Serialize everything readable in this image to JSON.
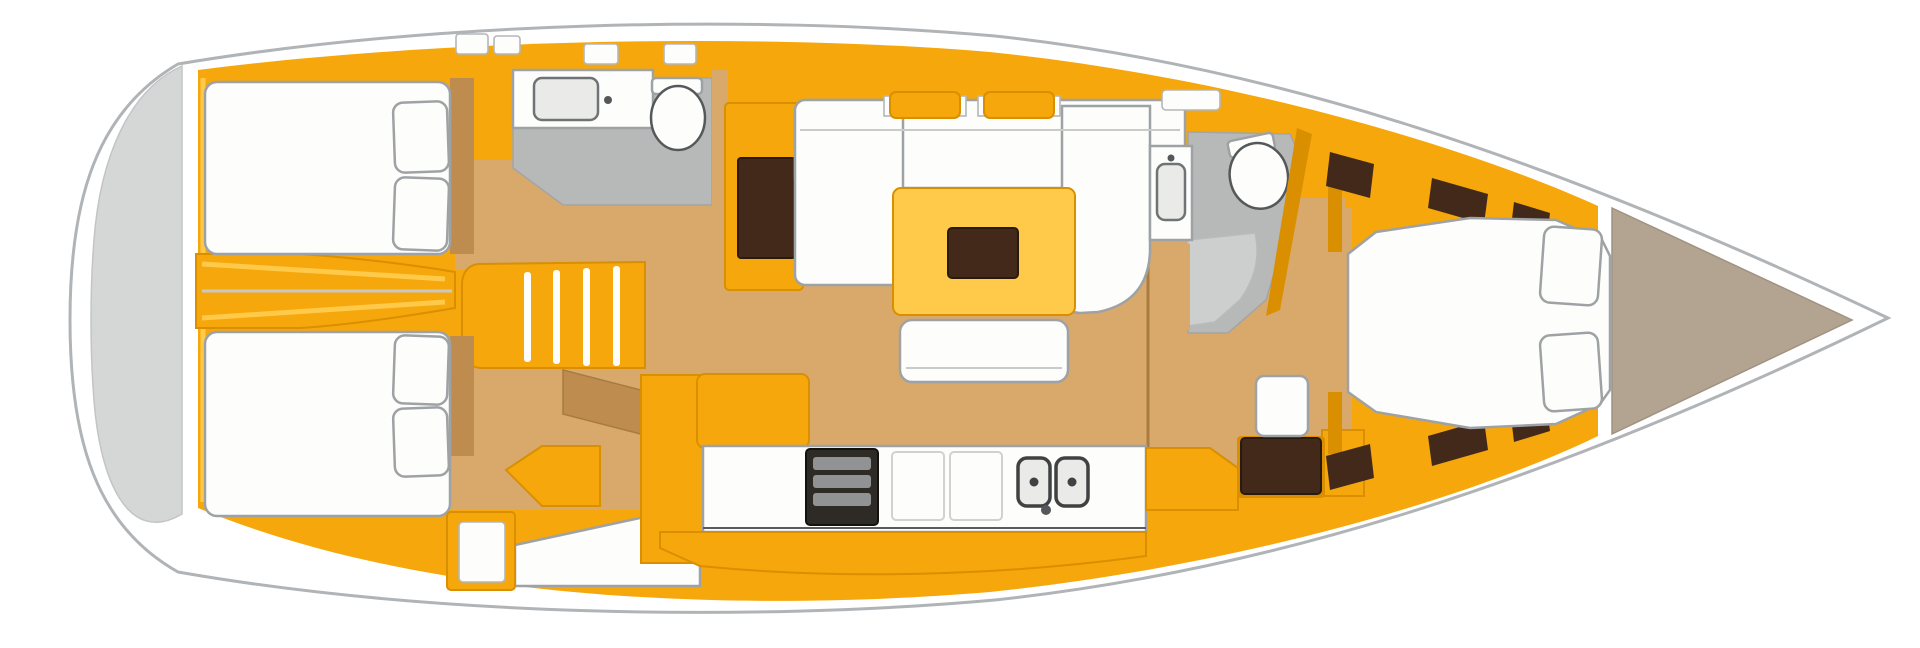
{
  "figure": {
    "kind": "sailing-yacht-interior-floor-plan",
    "orientation": "bow-right",
    "cabins": 3,
    "heads": 2,
    "berth_pillows_aft_port": 2,
    "berth_pillows_aft_starboard": 2,
    "berth_pillows_forward": 2,
    "companionway_steps": 4,
    "galley_burners": 1,
    "galley_sinks": 2
  },
  "legend": [
    "swim-platform",
    "aft-cabin-port",
    "aft-cabin-starboard",
    "engine-compartment",
    "companionway",
    "aft-head",
    "salon",
    "galley",
    "nav-station",
    "forward-head",
    "forward-cabin",
    "anchor-locker"
  ],
  "palette": {
    "page_bg": "#ffffff",
    "hull_fill": "#ffffff",
    "hull_outline": "#b0b4b7",
    "transom_grey": "#d5d7d6",
    "amber": "#f6a70b",
    "amber_light": "#ffc94a",
    "amber_dark": "#d98f00",
    "wood": "#d8a96b",
    "wood_dark": "#bf8c4f",
    "white_fixture": "#fdfdfb",
    "fixture_outline": "#9ea2a5",
    "head_floor": "#b7b9b8",
    "head_floor_light": "#cdcfce",
    "dark_brown": "#43291a",
    "stove_dark": "#2e2a26",
    "stove_grid": "#909294",
    "sink_steel": "#eaebe9",
    "bow_deck": "#b3a492",
    "mast_line": "#a97c3f"
  }
}
